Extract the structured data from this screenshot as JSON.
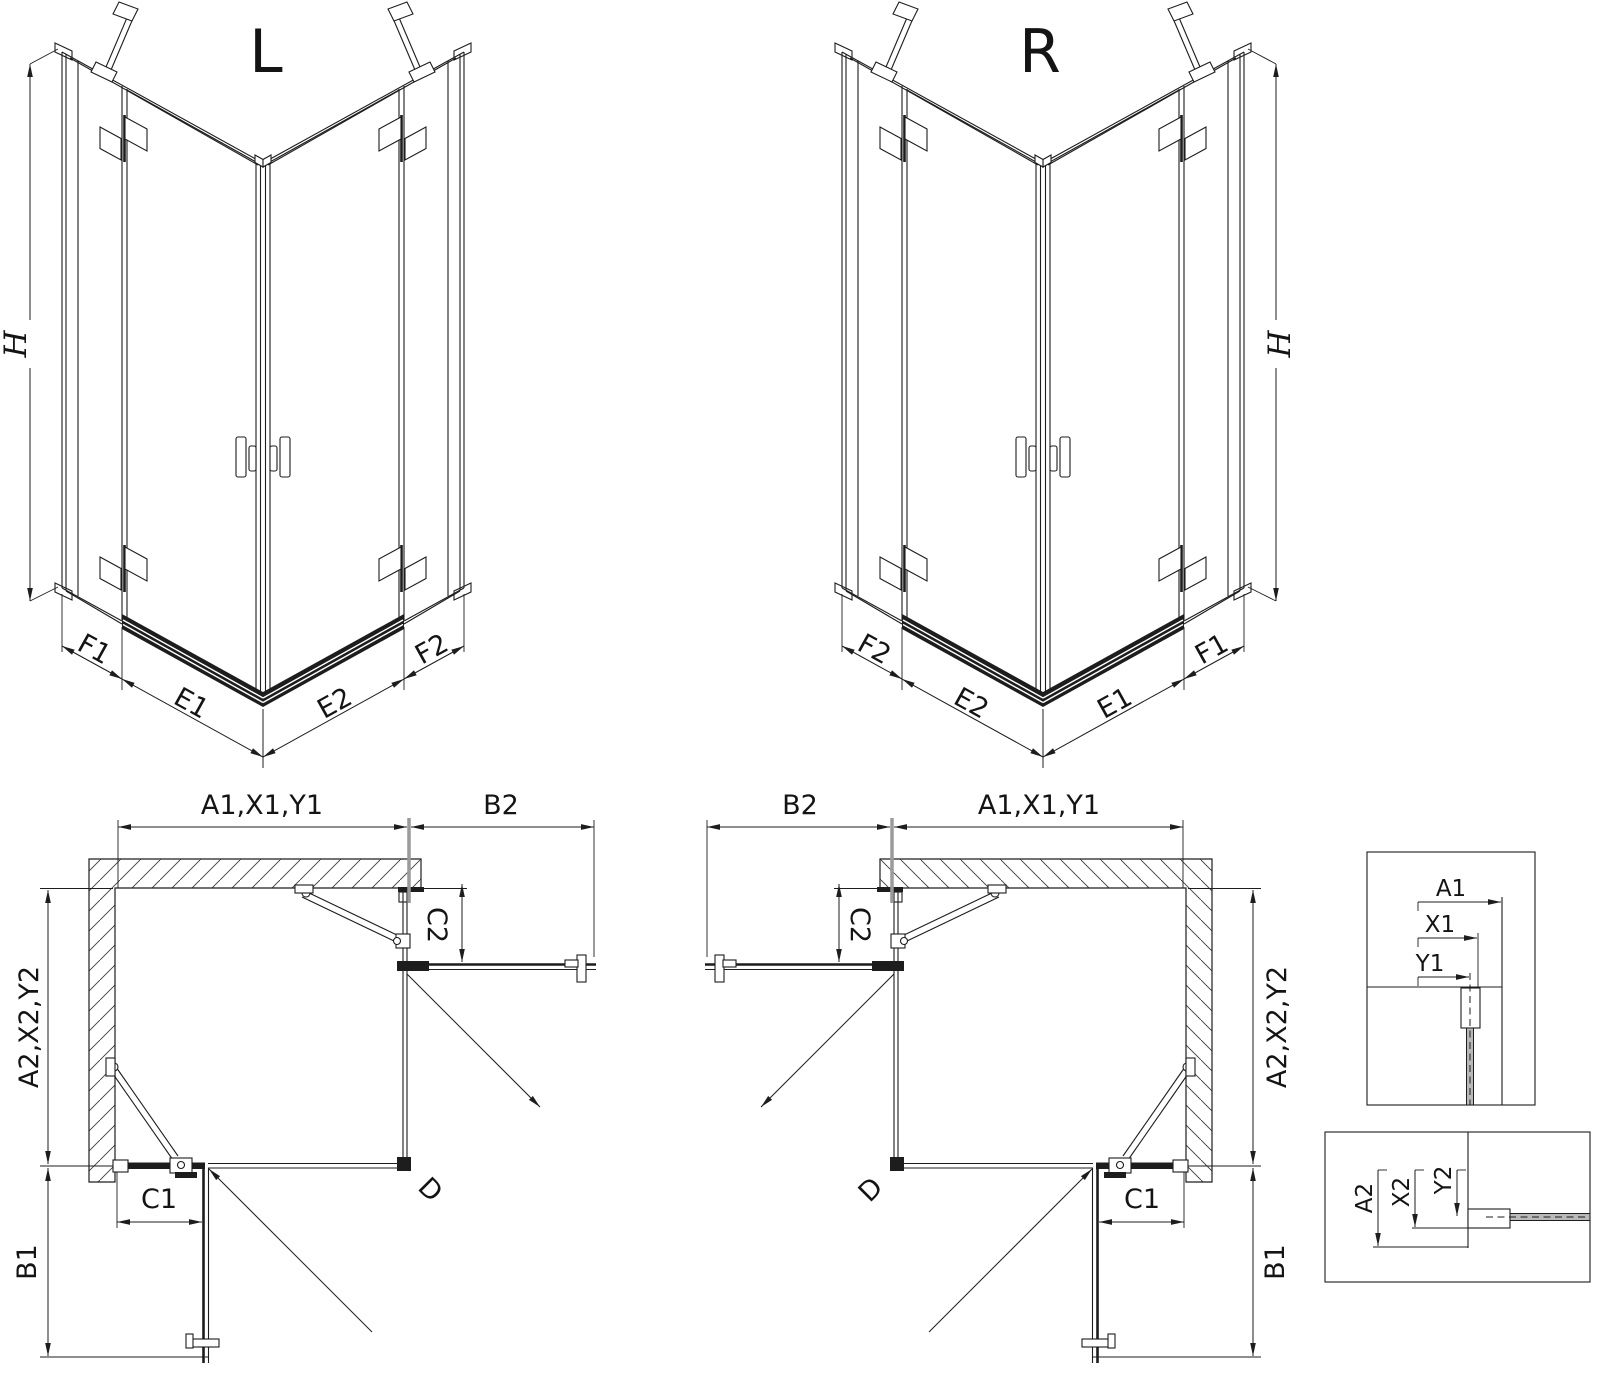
{
  "views": {
    "iso_left": {
      "title": "L",
      "h": "H",
      "f1": "F1",
      "e1": "E1",
      "e2": "E2",
      "f2": "F2"
    },
    "iso_right": {
      "title": "R",
      "h": "H",
      "f1": "F1",
      "e1": "E1",
      "e2": "E2",
      "f2": "F2"
    },
    "plan_left": {
      "a1": "A1,X1,Y1",
      "b2": "B2",
      "c2": "C2",
      "a2": "A2,X2,Y2",
      "b1": "B1",
      "c1": "C1",
      "d": "D"
    },
    "plan_right": {
      "a1": "A1,X1,Y1",
      "b2": "B2",
      "c2": "C2",
      "a2": "A2,X2,Y2",
      "b1": "B1",
      "c1": "C1",
      "d": "D"
    },
    "detail_a1": {
      "a1": "A1",
      "x1": "X1",
      "y1": "Y1"
    },
    "detail_a2": {
      "a2": "A2",
      "x2": "X2",
      "y2": "Y2"
    }
  },
  "colors": {
    "line": "#1d1d1d",
    "text": "#141414",
    "gray_extension": "#9b9b9b",
    "glass_fill": "#b9b9b9",
    "hatch": "#3a3a3a",
    "background": "#ffffff"
  }
}
